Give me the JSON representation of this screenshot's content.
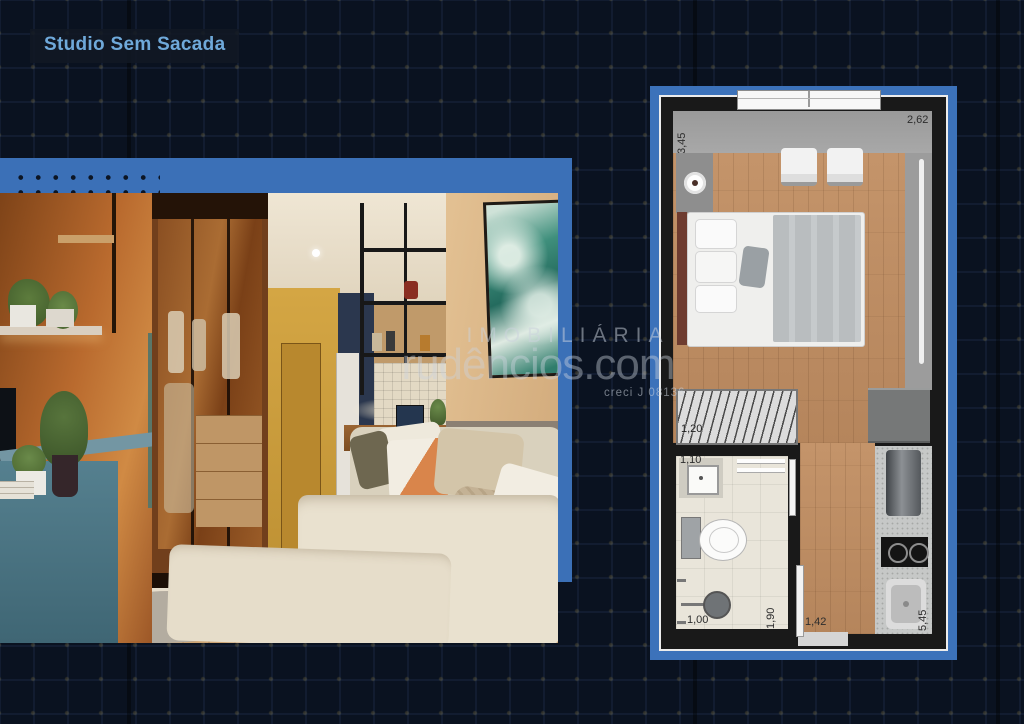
{
  "page": {
    "title_badge": "Studio Sem Sacada"
  },
  "watermark": {
    "brand_top": "IMOBILIÁRIA",
    "brand_main": "rudêncios.com",
    "license": "creci J 08136"
  },
  "floor_plan": {
    "dimensions": {
      "main_depth": "3,45",
      "main_width": "2,62",
      "wardrobe_width": "1,20",
      "bathroom_width": "1,10",
      "bathroom_inner_width": "1,00",
      "bathroom_depth": "1,90",
      "entry_width": "1,42",
      "total_depth": "5,45"
    },
    "fixtures": [
      "window",
      "lounge-chairs",
      "tv-console",
      "bed",
      "wardrobe",
      "bathroom-vanity",
      "toilet",
      "shower",
      "bathroom-door",
      "entry-door",
      "kitchen-cabinet",
      "fridge",
      "cooktop",
      "kitchen-sink",
      "curtain"
    ]
  },
  "colors": {
    "accent_blue": "#3c72ba",
    "background_navy": "#0a1220",
    "title_text": "#6fa9da"
  }
}
